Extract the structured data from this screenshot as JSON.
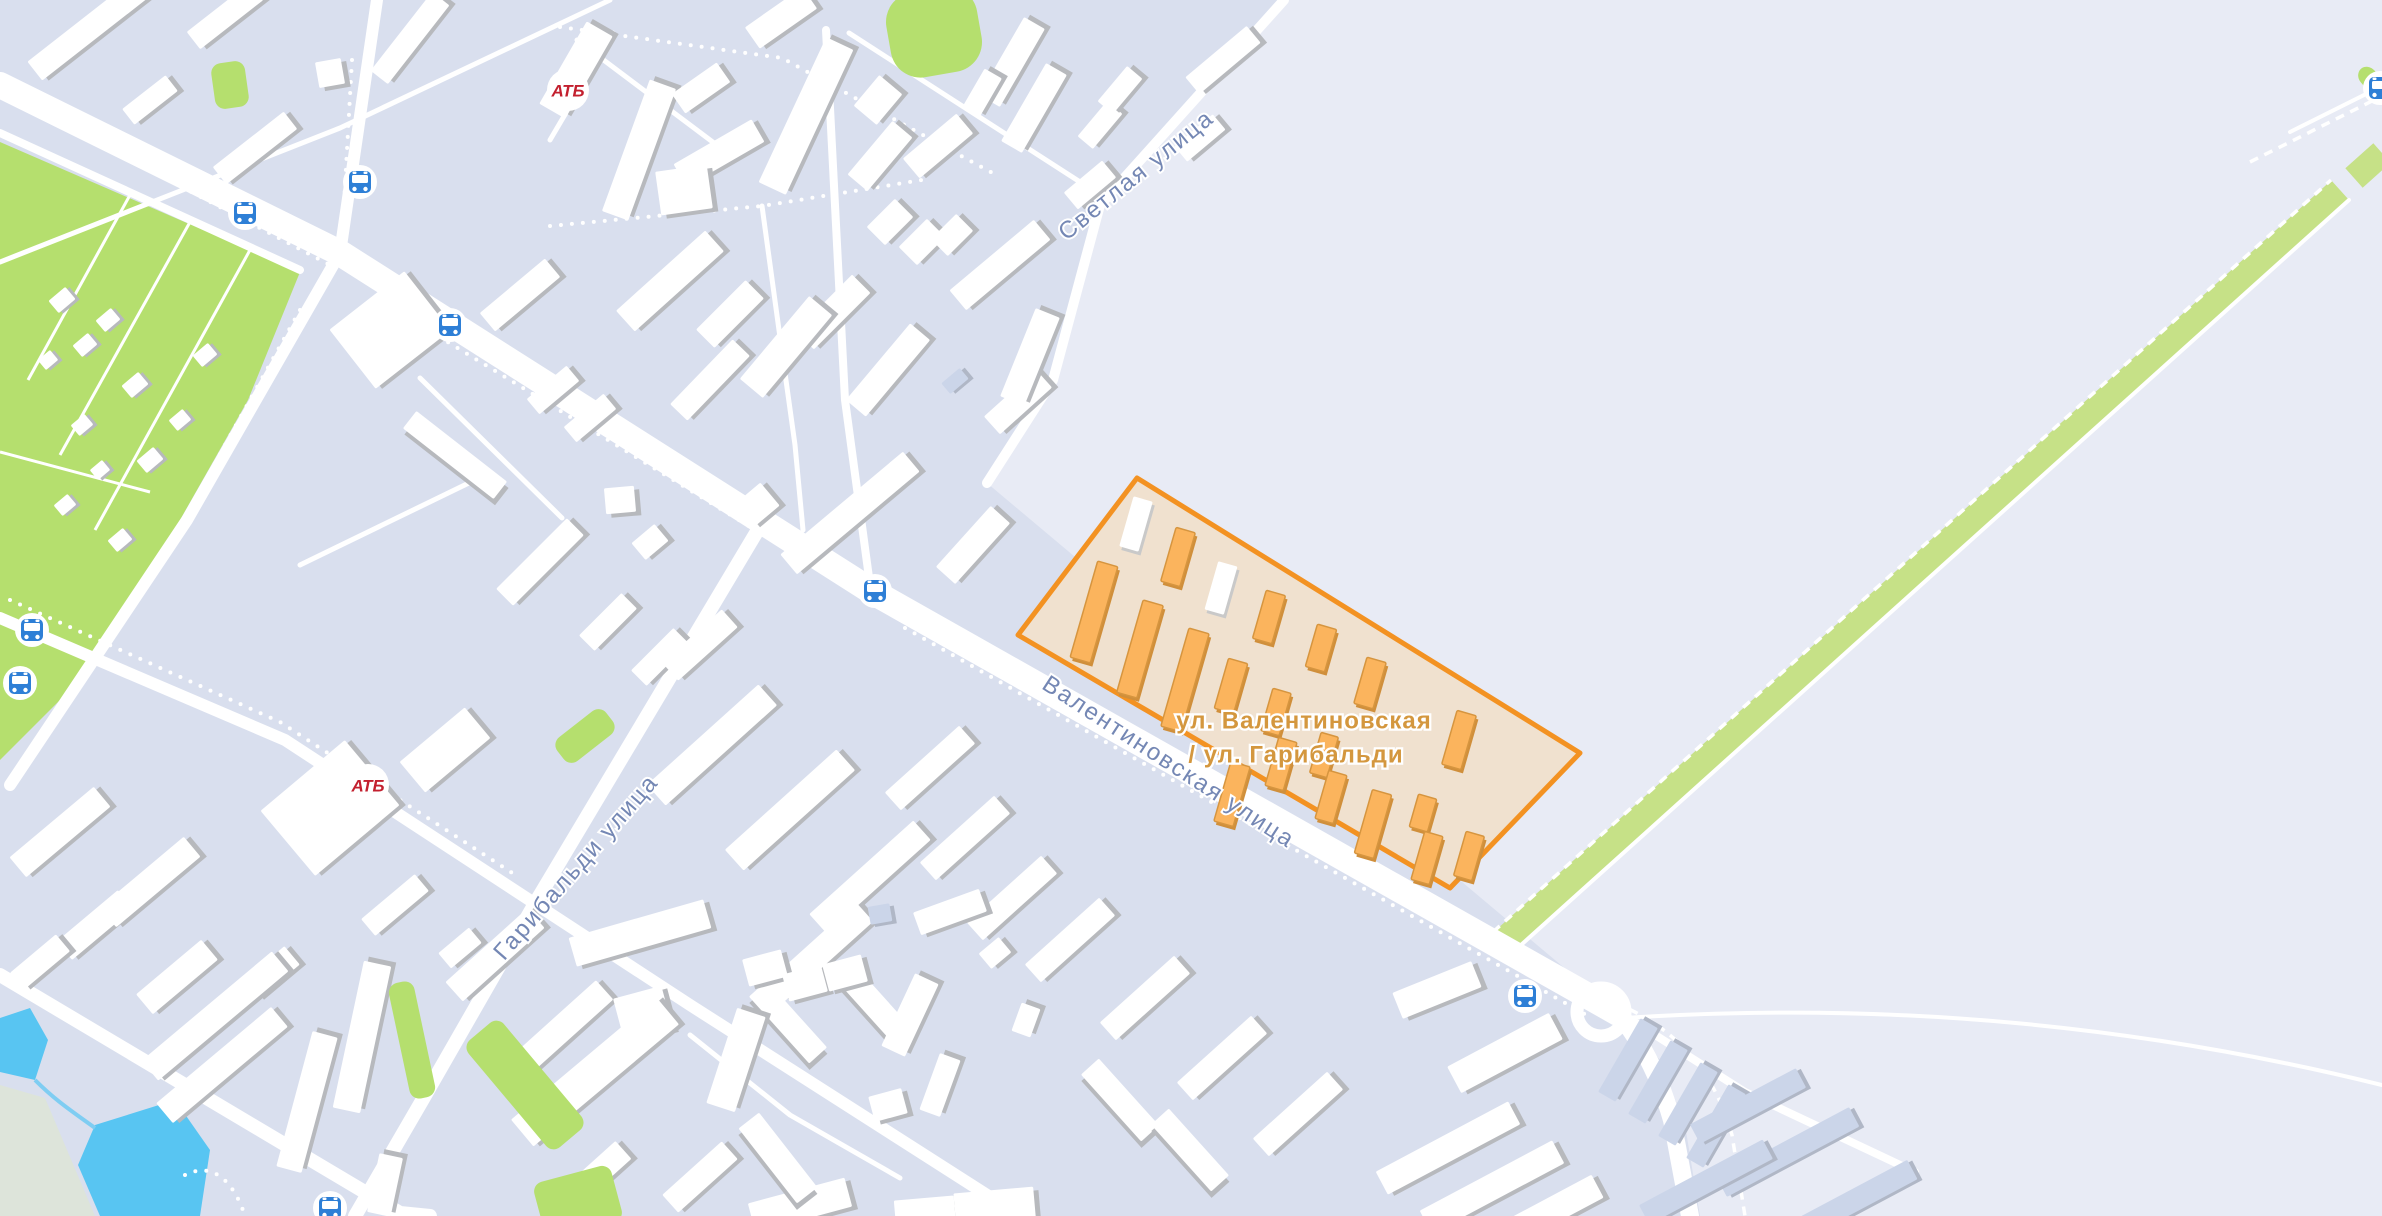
{
  "map": {
    "street_labels": {
      "svetlaya": "Светлая улица",
      "valentinovskaya": "Валентиновская улица",
      "garibaldi": "Гарибальди улица"
    },
    "zone": {
      "label_line1": "ул. Валентиновская",
      "label_line2": "/ ул. Гарибальди",
      "border_color": "#f39222",
      "fill_color": "#f0e1cf",
      "building_color": "#fbb45d",
      "building_edge_color": "#d6953f",
      "label_color": "#d4973e"
    },
    "poi": {
      "atb_store_label": "АТБ",
      "atb_color": "#c3202f"
    },
    "icons": {
      "bus_stop": "bus-stop-icon"
    },
    "colors": {
      "urban_bg": "#d9dfee",
      "field_bg": "#e8ebf5",
      "road": "#ffffff",
      "park_green": "#b5df6e",
      "tree_green": "#c6e187",
      "water_blue": "#58c5f2",
      "bus_blue": "#2e7fd6",
      "street_label": "#7487b4",
      "building_white": "#ffffff",
      "building_shadow": "#b7b9bd",
      "garage_fill": "#cbd5e9"
    }
  }
}
